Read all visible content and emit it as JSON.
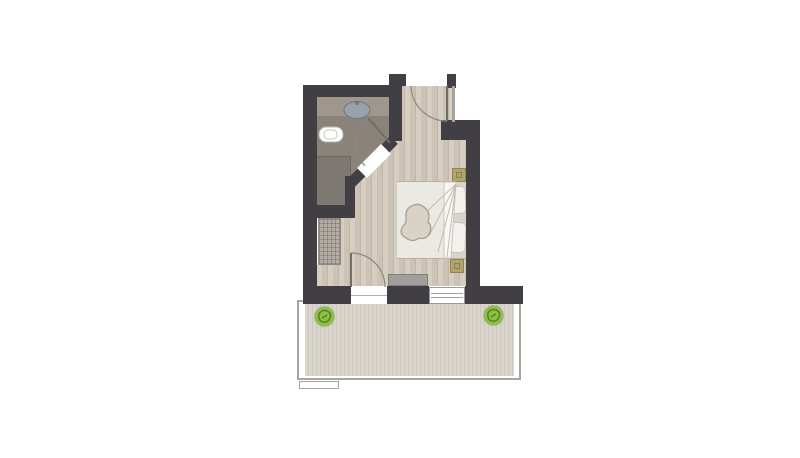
{
  "scene": {
    "type": "architectural floor plan, top-down, no text labels",
    "rooms": [
      {
        "name": "bathroom",
        "position": "top-left",
        "floor": "gray tile"
      },
      {
        "name": "entry-hall",
        "position": "top-right",
        "floor": "light wood planks"
      },
      {
        "name": "bedroom",
        "position": "center",
        "floor": "light wood planks"
      },
      {
        "name": "balcony",
        "position": "bottom",
        "floor": "striped wood decking"
      }
    ],
    "fixtures": [
      "washbasin-oval-on-counter",
      "toilet",
      "shower-area",
      "built-in-wardrobe-hatched",
      "entry-door-with-swing-arc",
      "bathroom-door-in-diagonal-wall-with-swing-arc",
      "balcony-door-with-swing-arc",
      "window-in-bottom-wall",
      "glass-strip-right-of-entry"
    ],
    "furniture": [
      "double-bed-with-white-duvet-and-sketched-blanket",
      "two-pillows-against-right-wall",
      "nightstand-upper",
      "nightstand-lower",
      "gray-bench-at-bottom-wall",
      "potted-plant-left-on-balcony",
      "potted-plant-right-on-balcony"
    ]
  },
  "colors": {
    "paper": "#ffffff",
    "wall": "#413f43",
    "wood-a": "#d6cec1",
    "wood-b": "#ccc3b6",
    "wood-line": "#c0b7a9",
    "bath-floor": "#8a837b",
    "counter": "#a0978c",
    "shower": "#7e7872",
    "wardrobe": "#b3ada5",
    "deck-a": "#d9d5cc",
    "deck-b": "#cdc9c0",
    "railing": "#a8a59e",
    "plant": "#8cbf44",
    "plant-dark": "#567d26",
    "bed-base": "#d9d3c9",
    "duvet": "#ebe9e4",
    "pillow": "#f2f1ee",
    "nightstand": "#b1a46d",
    "bench": "#a09f9c",
    "glass": "#a5a3a0",
    "door-line": "#8a8880"
  }
}
